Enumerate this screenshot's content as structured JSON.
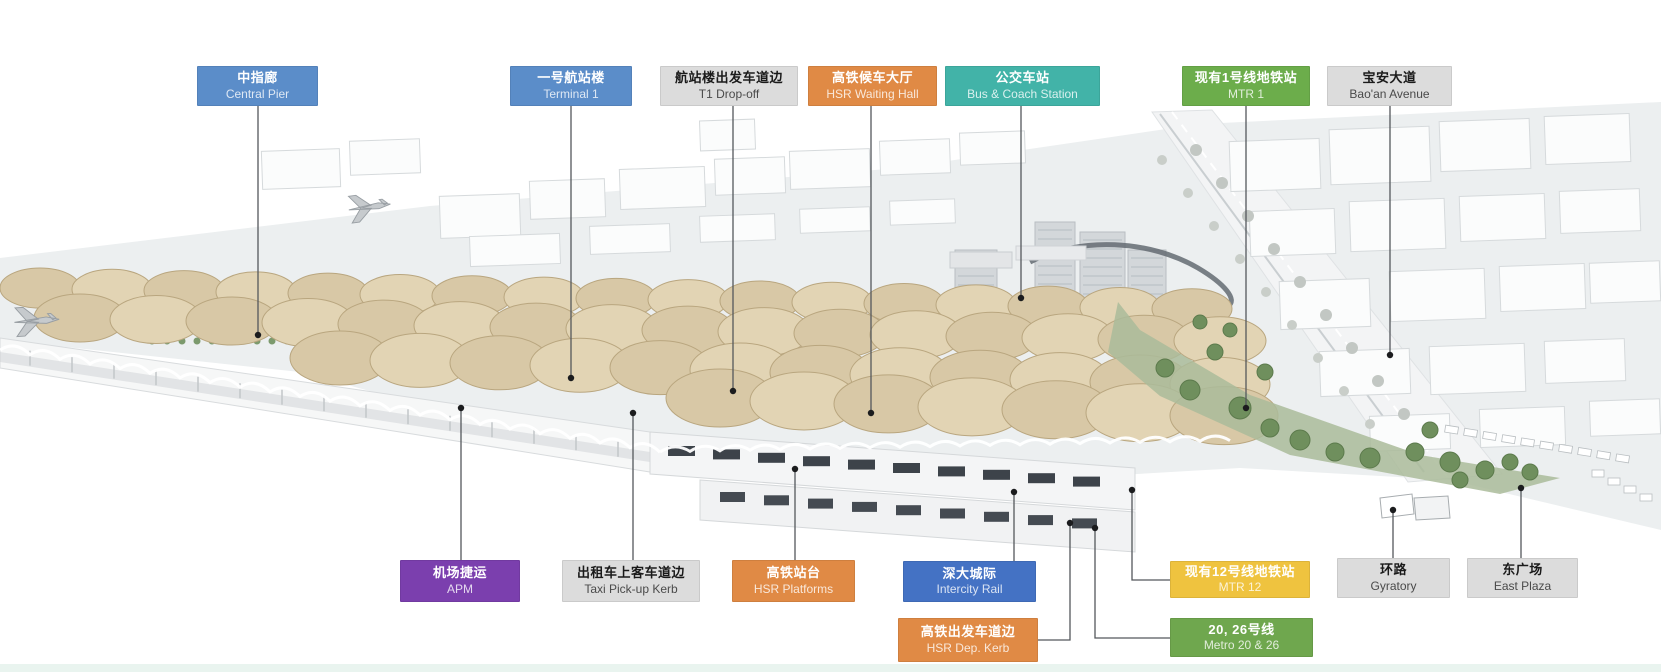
{
  "canvas": {
    "width": 1661,
    "height": 672,
    "background": "#ffffff"
  },
  "footer_bar": {
    "color": "#e9f4ef"
  },
  "palette": {
    "label_blue": "#5B8DC9",
    "label_deep_blue": "#4472C4",
    "label_orange": "#E08A45",
    "label_teal": "#42B3A8",
    "label_green": "#6CAD4B",
    "label_green_dark": "#6FA74E",
    "label_yellow": "#EFC33F",
    "label_purple": "#7B3FAE",
    "label_gray": "#DCDCDC",
    "leader_line": "#54585c",
    "leader_dot": "#1b1c1e",
    "canopy_tan": "#d8c8a6",
    "ground_gray": "#eceff0",
    "greenery": "#6f8f5d"
  },
  "labels": [
    {
      "id": "central-pier",
      "cn": "中指廊",
      "en": "Central Pier",
      "bg": "#5B8DC9",
      "text": "light",
      "x": 197,
      "y": 66,
      "w": 121,
      "h": 40,
      "line": [
        [
          258,
          106
        ],
        [
          258,
          335
        ]
      ]
    },
    {
      "id": "terminal-1",
      "cn": "一号航站楼",
      "en": "Terminal 1",
      "bg": "#5B8DC9",
      "text": "light",
      "x": 510,
      "y": 66,
      "w": 122,
      "h": 40,
      "line": [
        [
          571,
          106
        ],
        [
          571,
          378
        ]
      ]
    },
    {
      "id": "t1-drop-off",
      "cn": "航站楼出发车道边",
      "en": "T1 Drop-off",
      "bg": "#DCDCDC",
      "text": "dark",
      "x": 660,
      "y": 66,
      "w": 138,
      "h": 40,
      "line": [
        [
          733,
          106
        ],
        [
          733,
          391
        ]
      ]
    },
    {
      "id": "hsr-waiting-hall",
      "cn": "高铁候车大厅",
      "en": "HSR Waiting Hall",
      "bg": "#E08A45",
      "text": "light",
      "x": 808,
      "y": 66,
      "w": 129,
      "h": 40,
      "line": [
        [
          871,
          106
        ],
        [
          871,
          413
        ]
      ]
    },
    {
      "id": "bus-coach-station",
      "cn": "公交车站",
      "en": "Bus & Coach Station",
      "bg": "#42B3A8",
      "text": "light",
      "x": 945,
      "y": 66,
      "w": 155,
      "h": 40,
      "line": [
        [
          1021,
          106
        ],
        [
          1021,
          298
        ]
      ]
    },
    {
      "id": "mtr-1",
      "cn": "现有1号线地铁站",
      "en": "MTR 1",
      "bg": "#6CAD4B",
      "text": "light",
      "x": 1182,
      "y": 66,
      "w": 128,
      "h": 40,
      "line": [
        [
          1246,
          106
        ],
        [
          1246,
          408
        ]
      ]
    },
    {
      "id": "baoan-avenue",
      "cn": "宝安大道",
      "en": "Bao'an Avenue",
      "bg": "#DCDCDC",
      "text": "dark",
      "x": 1327,
      "y": 66,
      "w": 125,
      "h": 40,
      "line": [
        [
          1390,
          106
        ],
        [
          1390,
          355
        ]
      ]
    },
    {
      "id": "apm",
      "cn": "机场捷运",
      "en": "APM",
      "bg": "#7B3FAE",
      "text": "light",
      "x": 400,
      "y": 560,
      "w": 120,
      "h": 42,
      "line": [
        [
          461,
          560
        ],
        [
          461,
          408
        ]
      ]
    },
    {
      "id": "taxi-pickup-kerb",
      "cn": "出租车上客车道边",
      "en": "Taxi Pick-up Kerb",
      "bg": "#DCDCDC",
      "text": "dark",
      "x": 562,
      "y": 560,
      "w": 138,
      "h": 42,
      "line": [
        [
          633,
          560
        ],
        [
          633,
          413
        ]
      ]
    },
    {
      "id": "hsr-platforms",
      "cn": "高铁站台",
      "en": "HSR Platforms",
      "bg": "#E08A45",
      "text": "light",
      "x": 732,
      "y": 560,
      "w": 123,
      "h": 42,
      "line": [
        [
          795,
          560
        ],
        [
          795,
          469
        ]
      ]
    },
    {
      "id": "intercity-rail",
      "cn": "深大城际",
      "en": "Intercity Rail",
      "bg": "#4472C4",
      "text": "light",
      "x": 903,
      "y": 561,
      "w": 133,
      "h": 41,
      "line": [
        [
          1014,
          561
        ],
        [
          1014,
          492
        ]
      ]
    },
    {
      "id": "mtr-12",
      "cn": "现有12号线地铁站",
      "en": "MTR 12",
      "bg": "#EFC33F",
      "text": "light",
      "x": 1170,
      "y": 561,
      "w": 140,
      "h": 37,
      "line": [
        [
          1170,
          580
        ],
        [
          1132,
          580
        ],
        [
          1132,
          490
        ]
      ]
    },
    {
      "id": "hsr-dep-kerb",
      "cn": "高铁出发车道边",
      "en": "HSR Dep. Kerb",
      "bg": "#E08A45",
      "text": "light",
      "x": 898,
      "y": 618,
      "w": 140,
      "h": 44,
      "line": [
        [
          1038,
          640
        ],
        [
          1070,
          640
        ],
        [
          1070,
          523
        ]
      ]
    },
    {
      "id": "metro-20-26",
      "cn": "20, 26号线",
      "en": "Metro 20 & 26",
      "bg": "#6FA74E",
      "text": "light",
      "x": 1170,
      "y": 618,
      "w": 143,
      "h": 39,
      "line": [
        [
          1170,
          638
        ],
        [
          1095,
          638
        ],
        [
          1095,
          528
        ]
      ]
    },
    {
      "id": "gyratory",
      "cn": "环路",
      "en": "Gyratory",
      "bg": "#DCDCDC",
      "text": "dark",
      "x": 1337,
      "y": 558,
      "w": 113,
      "h": 40,
      "line": [
        [
          1393,
          558
        ],
        [
          1393,
          510
        ]
      ]
    },
    {
      "id": "east-plaza",
      "cn": "东广场",
      "en": "East Plaza",
      "bg": "#DCDCDC",
      "text": "dark",
      "x": 1467,
      "y": 558,
      "w": 111,
      "h": 40,
      "line": [
        [
          1521,
          558
        ],
        [
          1521,
          488
        ]
      ]
    }
  ]
}
